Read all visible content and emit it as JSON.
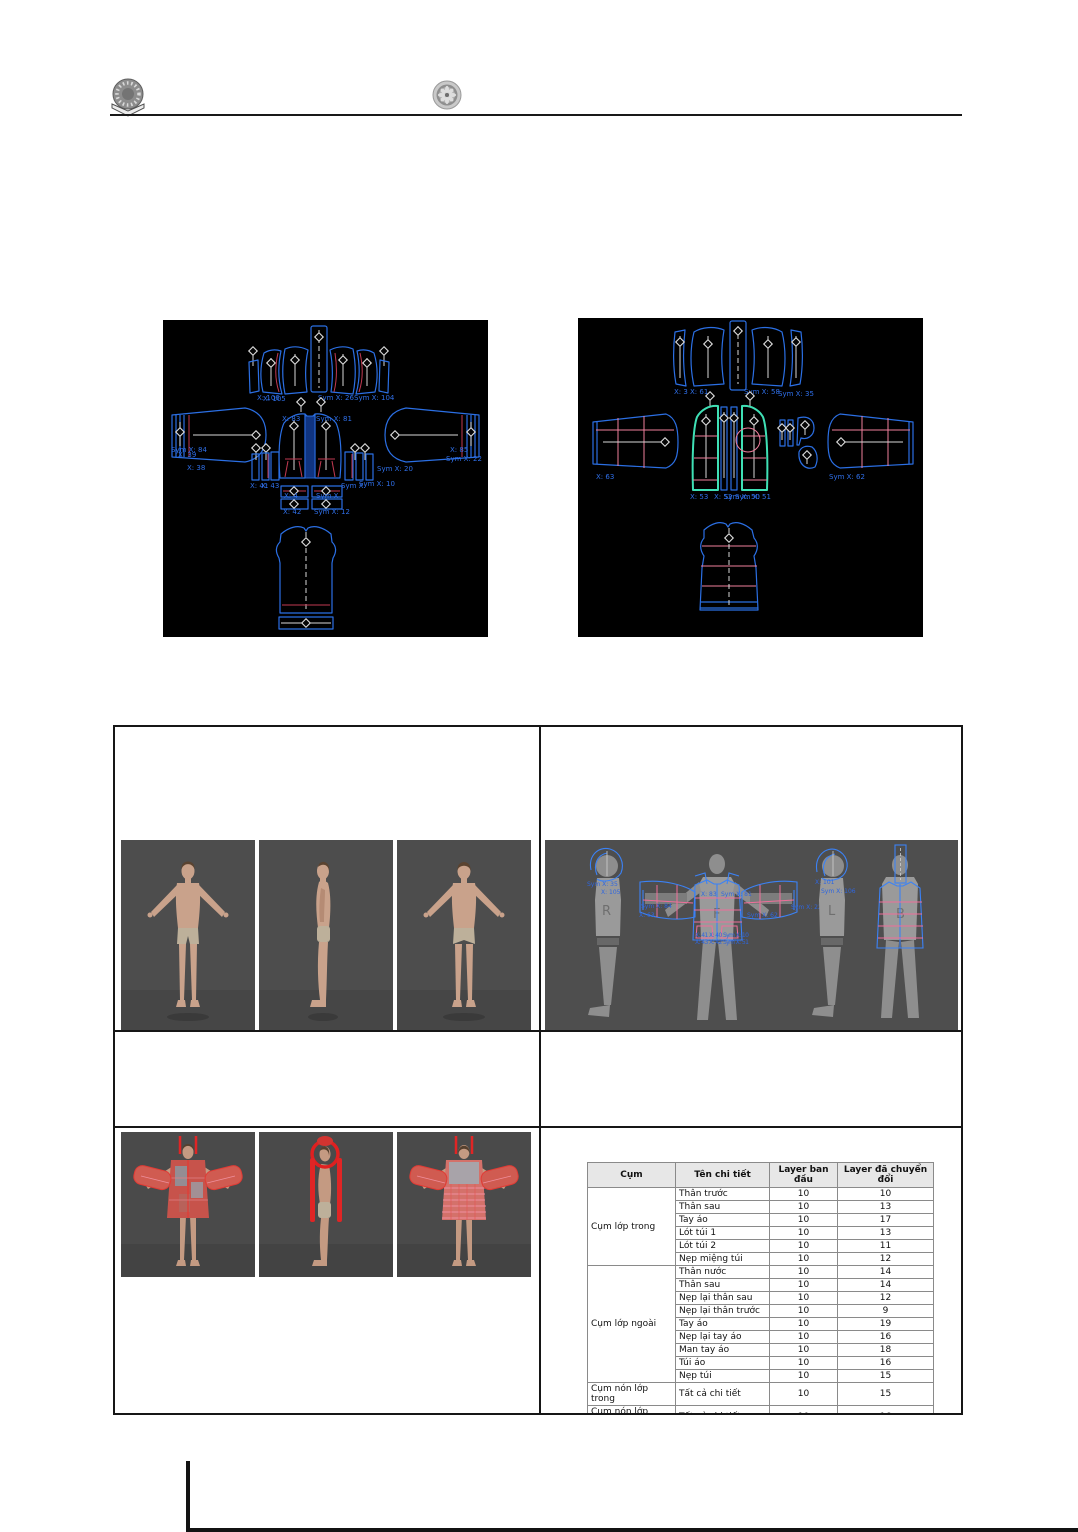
{
  "header": {
    "left_logo": "university-crest",
    "right_logo": "faculty-gear-emblem"
  },
  "figA": {
    "description": "2D pattern pieces of jacket before layer conversion (black CAD viewport)",
    "labels": {
      "hood_l1": "X: 106",
      "hood_l2": "X: 105",
      "hood_r1": "Sym X: 26",
      "hood_r2": "Sym X: 104",
      "sleeve_l1": "Sym X: 84",
      "sleeve_l2": "X: 39",
      "sleeve_l3": "X: 38",
      "front_l": "X: 83",
      "front_r": "Sym X: 81",
      "sleeve_r1": "X: 85",
      "sleeve_r2": "Sym X: 22",
      "sleeve_r3": "Sym X: 20",
      "small_l1": "X: 41",
      "small_l2": "X: 43",
      "small_r1": "Sym X:",
      "small_r2": "Sym X: 10",
      "strip_l1": "X: 4",
      "strip_l2": "X: 42",
      "strip_r1": "Sym X",
      "strip_r2": "Sym X: 12"
    }
  },
  "figB": {
    "description": "2D pattern pieces of inner layer garment (black CAD viewport, highlighted fronts)",
    "labels": {
      "top1": "X: 3",
      "top2": "X: 61",
      "top3": "Sym X: 58",
      "top4": "Sym X: 35",
      "sleeve_l": "X: 63",
      "sleeve_r": "Sym X: 62",
      "bot1": "X: 53",
      "bot2": "X: 52",
      "bot3": "Sym X: 50",
      "bot4": "Sym X: 51"
    }
  },
  "layout2d": {
    "description": "2D arrangement window with avatar silhouettes and placed pattern pieces",
    "labels": {
      "r": "R",
      "f": "F",
      "l": "L",
      "b": "B",
      "hood_l_a": "Sym X: 35",
      "hood_l_b": "X: 105",
      "sleeve_l_a": "Sym X: 84",
      "sleeve_l_b": "X: 63",
      "chest_a": "X: 83",
      "chest_b": "Sym X: 81",
      "sleeve_r_a": "Sym X: 62",
      "sleeve_r_b": "Sym X: 22",
      "hood_r_a": "X: 101",
      "hood_r_b": "Sym X: 106",
      "cluster1": "X: 41 X: 40 Sym X: 10",
      "cluster2": "X: 43 X: 42 Sym X: 51"
    }
  },
  "layer_table": {
    "headers": [
      "Cụm",
      "Tên chi tiết",
      "Layer ban đầu",
      "Layer đã chuyển đổi"
    ],
    "groups": [
      {
        "name": "Cụm lớp trong",
        "rows": [
          {
            "part": "Thân trước",
            "before": "10",
            "after": "10"
          },
          {
            "part": "Thân sau",
            "before": "10",
            "after": "13"
          },
          {
            "part": "Tay áo",
            "before": "10",
            "after": "17"
          },
          {
            "part": "Lót túi 1",
            "before": "10",
            "after": "13"
          },
          {
            "part": "Lót túi 2",
            "before": "10",
            "after": "11"
          },
          {
            "part": "Nẹp miệng túi",
            "before": "10",
            "after": "12"
          }
        ]
      },
      {
        "name": "Cụm lớp ngoài",
        "rows": [
          {
            "part": "Thân nước",
            "before": "10",
            "after": "14"
          },
          {
            "part": "Thân sau",
            "before": "10",
            "after": "14"
          },
          {
            "part": "Nẹp lại thân sau",
            "before": "10",
            "after": "12"
          },
          {
            "part": "Nẹp lại thân trước",
            "before": "10",
            "after": "9"
          },
          {
            "part": "Tay áo",
            "before": "10",
            "after": "19"
          },
          {
            "part": "Nẹp lại tay áo",
            "before": "10",
            "after": "16"
          },
          {
            "part": "Man tay áo",
            "before": "10",
            "after": "18"
          },
          {
            "part": "Túi áo",
            "before": "10",
            "after": "16"
          },
          {
            "part": "Nẹp túi",
            "before": "10",
            "after": "15"
          }
        ]
      },
      {
        "name": "Cụm nón lớp trong",
        "rows": [
          {
            "part": "Tất cả chi tiết",
            "before": "10",
            "after": "15"
          }
        ]
      },
      {
        "name": "Cụm nón lớp ngoài",
        "rows": [
          {
            "part": "Tất cả chi tiết",
            "before": "10",
            "after": "16"
          }
        ]
      }
    ]
  },
  "colors": {
    "pattern_blue": "#2b6fe4",
    "pattern_red": "#c23a52",
    "pattern_pink": "#ef7f9d",
    "highlight_cyan": "#3fe0b5",
    "grain_white": "#d8d8d8",
    "viewport_black": "#000000",
    "viewport_gray": "#4e4e4e",
    "silhouette_gray": "#8e8e8e",
    "stress_red": "#e02525"
  }
}
